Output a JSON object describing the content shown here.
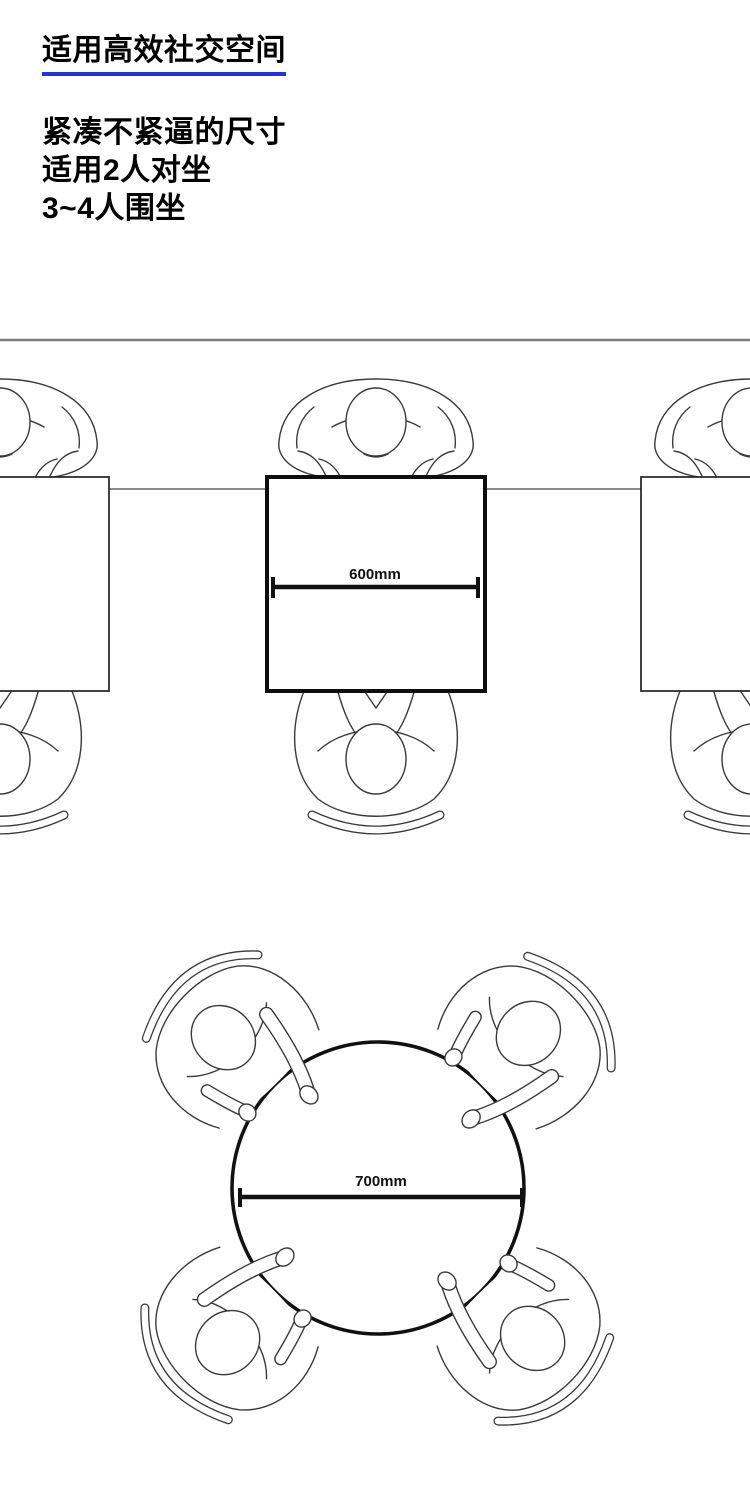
{
  "page": {
    "background": "#ffffff",
    "underline_color": "#2434d2",
    "line_art_color": "#3a3a3a",
    "dimension_color": "#111111",
    "divider_color": "#7d7d7d"
  },
  "header": {
    "title": "适用高效社交空间",
    "lines": [
      "紧凑不紧逼的尺寸",
      "适用2人对坐",
      "3~4人围坐"
    ]
  },
  "diagrams": {
    "square_table": {
      "dimension_label": "600mm"
    },
    "round_table": {
      "dimension_label": "700mm"
    }
  }
}
